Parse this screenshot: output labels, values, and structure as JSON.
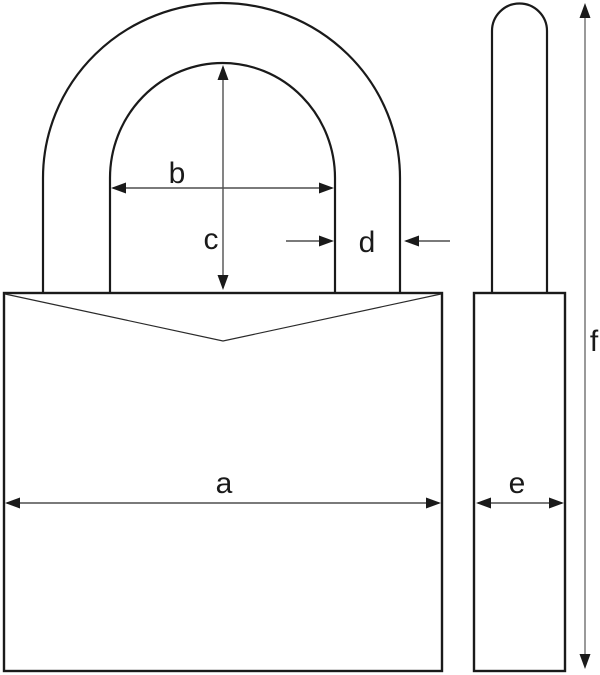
{
  "figure": {
    "description": "Padlock technical dimension drawing with front view and side view",
    "labels": {
      "a": "a",
      "b": "b",
      "c": "c",
      "d": "d",
      "e": "e",
      "f": "f"
    },
    "colors": {
      "background": "#ffffff",
      "outline": "#1a1a1a",
      "dimension_line": "#4f4f4f",
      "height_dimension_line": "#808080",
      "label_text": "#1a1a1a"
    }
  }
}
